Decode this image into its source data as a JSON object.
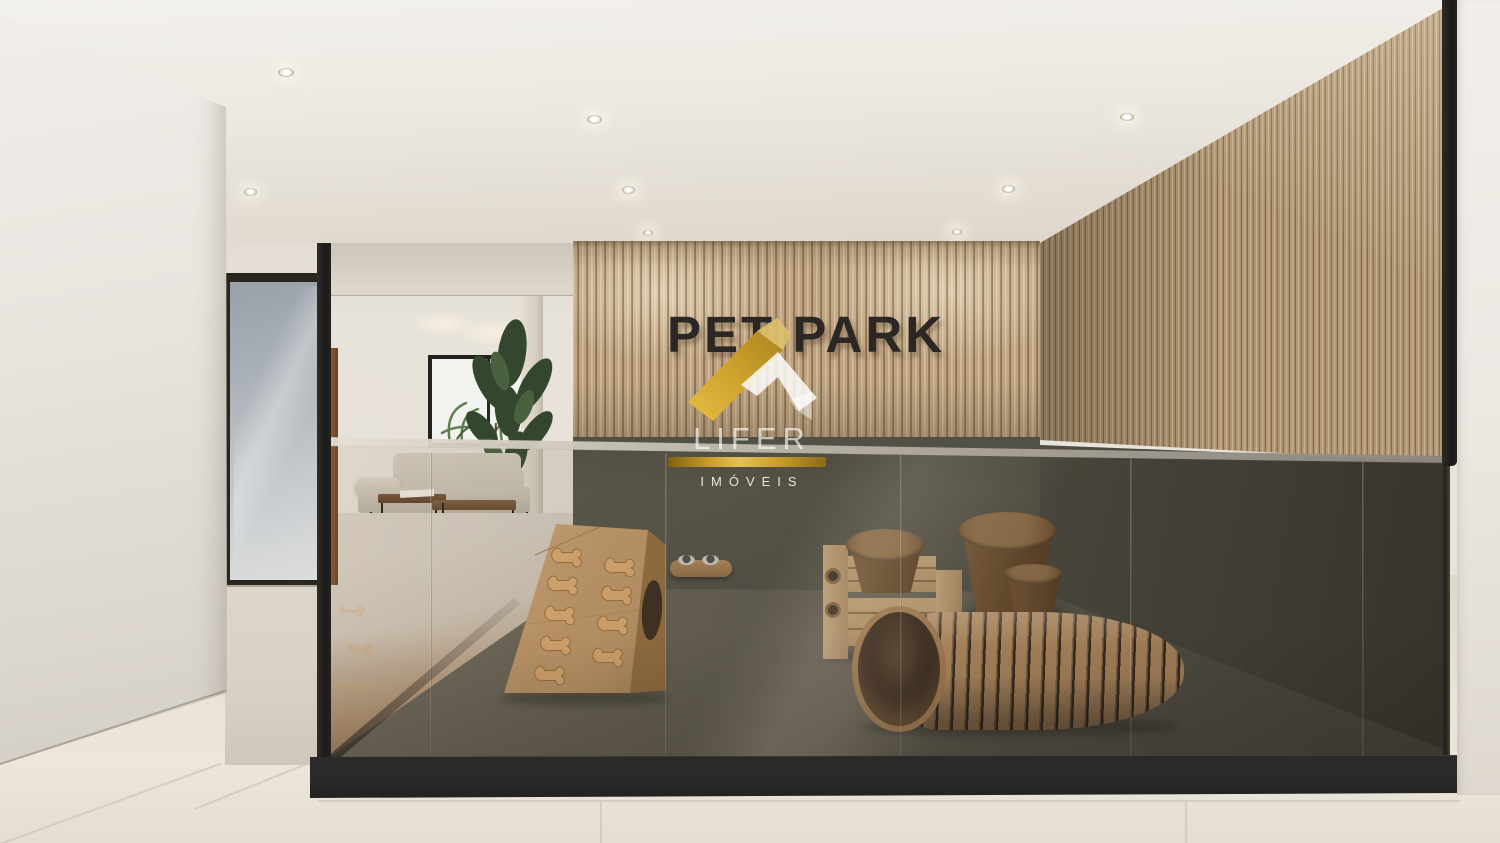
{
  "scene": {
    "type": "3d architectural render",
    "signage": {
      "wall_sign": "PET PARK"
    },
    "watermark": {
      "brand": "LIFER",
      "subtitle": "IMÓVEIS",
      "icon": "lifer-roof-logo",
      "gold": "#d4a937",
      "white": "#ffffff"
    },
    "colors": {
      "slat_wood": "#bfa37f",
      "slat_gap": "#6b5336",
      "lower_wall_green": "#53524a",
      "pet_floor": "#5d5a4f",
      "sign_text": "#2b2724",
      "ceiling": "#f0ece6",
      "outer_floor_tile": "#e8e2d7",
      "plinth_black": "#2c2a28",
      "furniture_wood": "#b98e60",
      "bone_tan": "#e0ad72",
      "frosted_glass": "#b8bdc2"
    },
    "objects": [
      "glass pet enclosure",
      "wood slat feature wall",
      "dog ramp with bone steps",
      "wall feeding bowls",
      "dog bridge",
      "wood stump stools",
      "wood dog tunnel",
      "frosted glass door",
      "daybed sofa",
      "coffee tables",
      "potted plant",
      "window with palms",
      "recessed ceiling downlights"
    ],
    "downlight_count": 8
  }
}
